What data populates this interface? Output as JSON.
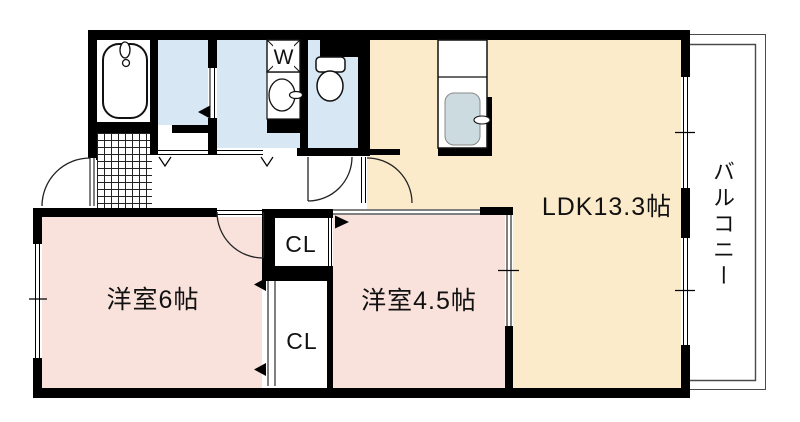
{
  "plan": {
    "rooms": {
      "ldk": {
        "label": "LDK13.3帖"
      },
      "bedroom_6": {
        "label": "洋室6帖"
      },
      "bedroom_45": {
        "label": "洋室4.5帖"
      },
      "closet_upper": {
        "label": "CL"
      },
      "closet_lower": {
        "label": "CL"
      },
      "balcony": {
        "label": "バルコニー"
      }
    },
    "fixtures": {
      "washer_label": "W"
    },
    "colors": {
      "ldk_fill": "#fcebca",
      "bedroom_fill": "#f9e1dc",
      "wet_area_fill": "#d7e7f4",
      "wall": "#000000",
      "balcony_line": "#4a4a4a",
      "sink_fill": "#ccdbdf"
    }
  }
}
